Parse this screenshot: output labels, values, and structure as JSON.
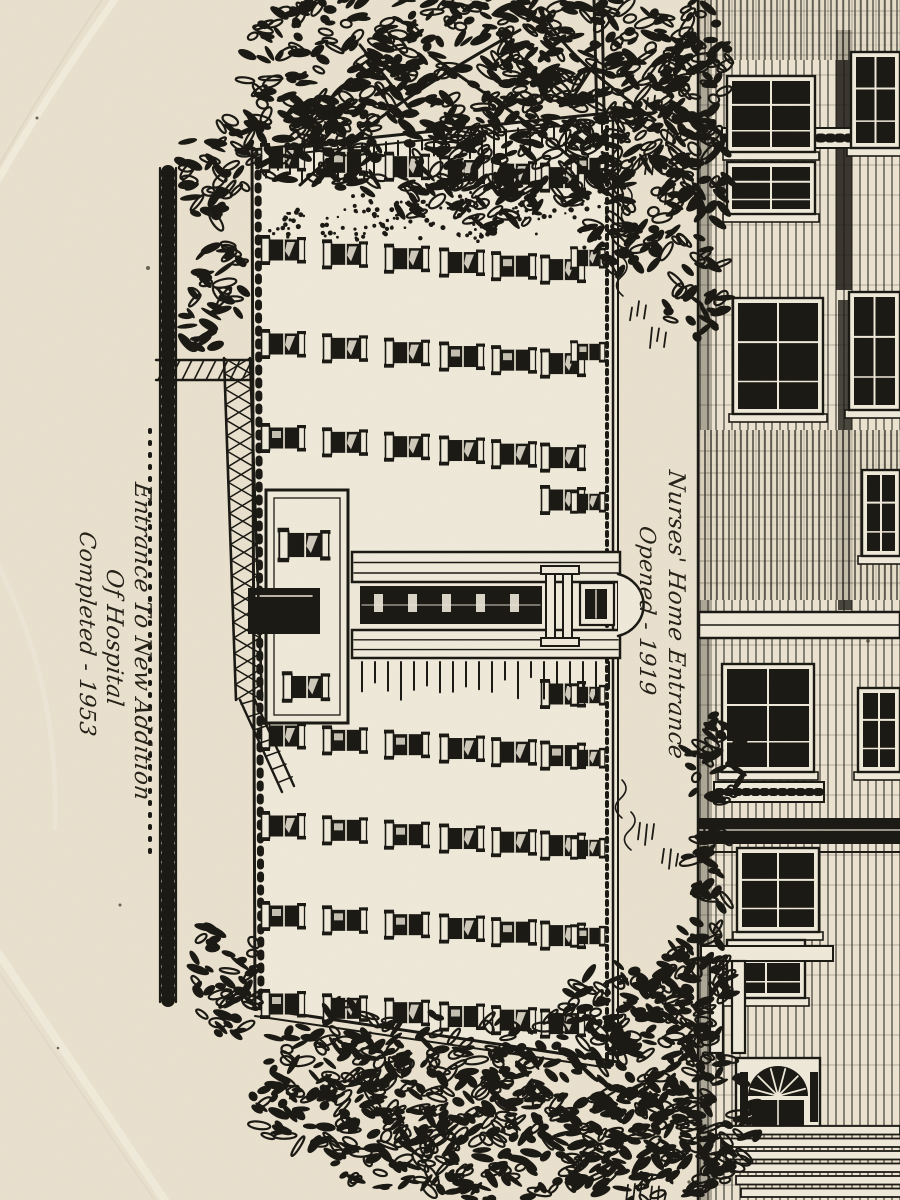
{
  "photo": {
    "description": "Black transfer-print engraving on a cream ceramic commemorative plate, photographed rotated 90 degrees",
    "subject": "Hospital new addition building and Nurses' Home entrance engraving"
  },
  "inscriptions": {
    "new_addition": {
      "line1": "Entrance To New Addition",
      "line2": "Of Hospital",
      "line3": "Completed - 1953"
    },
    "nurses_home": {
      "line1": "Nurses' Home Entrance",
      "line2": "Opened - 1919"
    }
  },
  "colors": {
    "ceramic_cream": "#ebe3d0",
    "facade_cream": "#f1ebdb",
    "ink_black": "#1b1914",
    "rim_highlight": "#f5efe1",
    "rim_shade": "#d9cebb"
  }
}
